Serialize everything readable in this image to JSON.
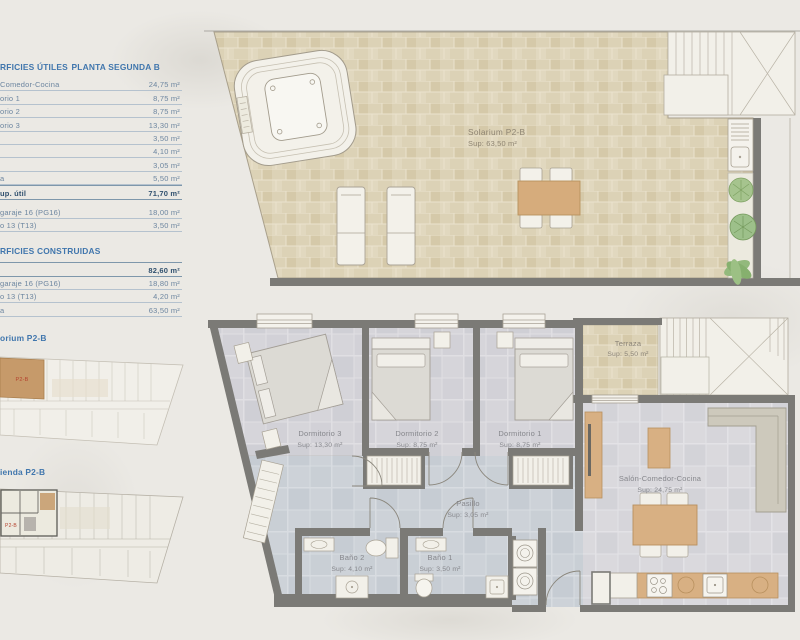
{
  "sidebar": {
    "utiles": {
      "header_left": "RFICIES ÚTILES",
      "header_right": "PLANTA SEGUNDA B",
      "rows": [
        {
          "label": "Comedor-Cocina",
          "value": "24,75 m²"
        },
        {
          "label": "orio 1",
          "value": "8,75 m²"
        },
        {
          "label": "orio 2",
          "value": "8,75 m²"
        },
        {
          "label": "orio 3",
          "value": "13,30 m²"
        },
        {
          "label": "",
          "value": "3,50 m²"
        },
        {
          "label": "",
          "value": "4,10 m²"
        },
        {
          "label": "",
          "value": "3,05 m²"
        },
        {
          "label": "a",
          "value": "5,50 m²"
        },
        {
          "label": "up. útil",
          "value": "71,70 m²"
        }
      ],
      "annex_rows": [
        {
          "label": "garaje 16 (PG16)",
          "value": "18,00 m²"
        },
        {
          "label": "o 13 (T13)",
          "value": "3,50 m²"
        }
      ]
    },
    "construidas": {
      "header": "RFICIES CONSTRUIDAS",
      "rows": [
        {
          "label": "",
          "value": "82,60 m²"
        },
        {
          "label": "garaje 16 (PG16)",
          "value": "18,80 m²"
        },
        {
          "label": "o 13 (T13)",
          "value": "4,20 m²"
        },
        {
          "label": "a",
          "value": "63,50 m²"
        }
      ]
    },
    "key_plans": [
      {
        "label": "orium P2-B",
        "unit": "P2-B"
      },
      {
        "label": "ienda P2-B",
        "unit": "P2-B"
      }
    ]
  },
  "solarium_plan": {
    "name": "Solarium P2-B",
    "sup": "Sup: 63,50 m²"
  },
  "apartment_plan": {
    "rooms": [
      {
        "name": "Terraza",
        "sup": "Sup: 5,50 m²"
      },
      {
        "name": "Dormitorio 3",
        "sup": "Sup: 13,30 m²"
      },
      {
        "name": "Dormitorio 2",
        "sup": "Sup: 8,75 m²"
      },
      {
        "name": "Dormitorio 1",
        "sup": "Sup: 8,75 m²"
      },
      {
        "name": "Salón-Comedor-Cocina",
        "sup": "Sup: 24,75 m²"
      },
      {
        "name": "Pasillo",
        "sup": "Sup: 3,05 m²"
      },
      {
        "name": "Baño 2",
        "sup": "Sup: 4,10 m²"
      },
      {
        "name": "Baño 1",
        "sup": "Sup: 3,50 m²"
      }
    ]
  },
  "colors": {
    "accent_blue": "#4076ad",
    "table_text": "#6d86a0",
    "wall_gray": "#7b7a76",
    "wood": "#d8b083",
    "brick_beige": "#dcd2b6",
    "tile_gray": "#d6d5da",
    "tile_blue": "#cdd2d8",
    "paper": "#ebe9e4",
    "highlight_unit": "#c69a6a",
    "unit_label_red": "#b5432f"
  }
}
